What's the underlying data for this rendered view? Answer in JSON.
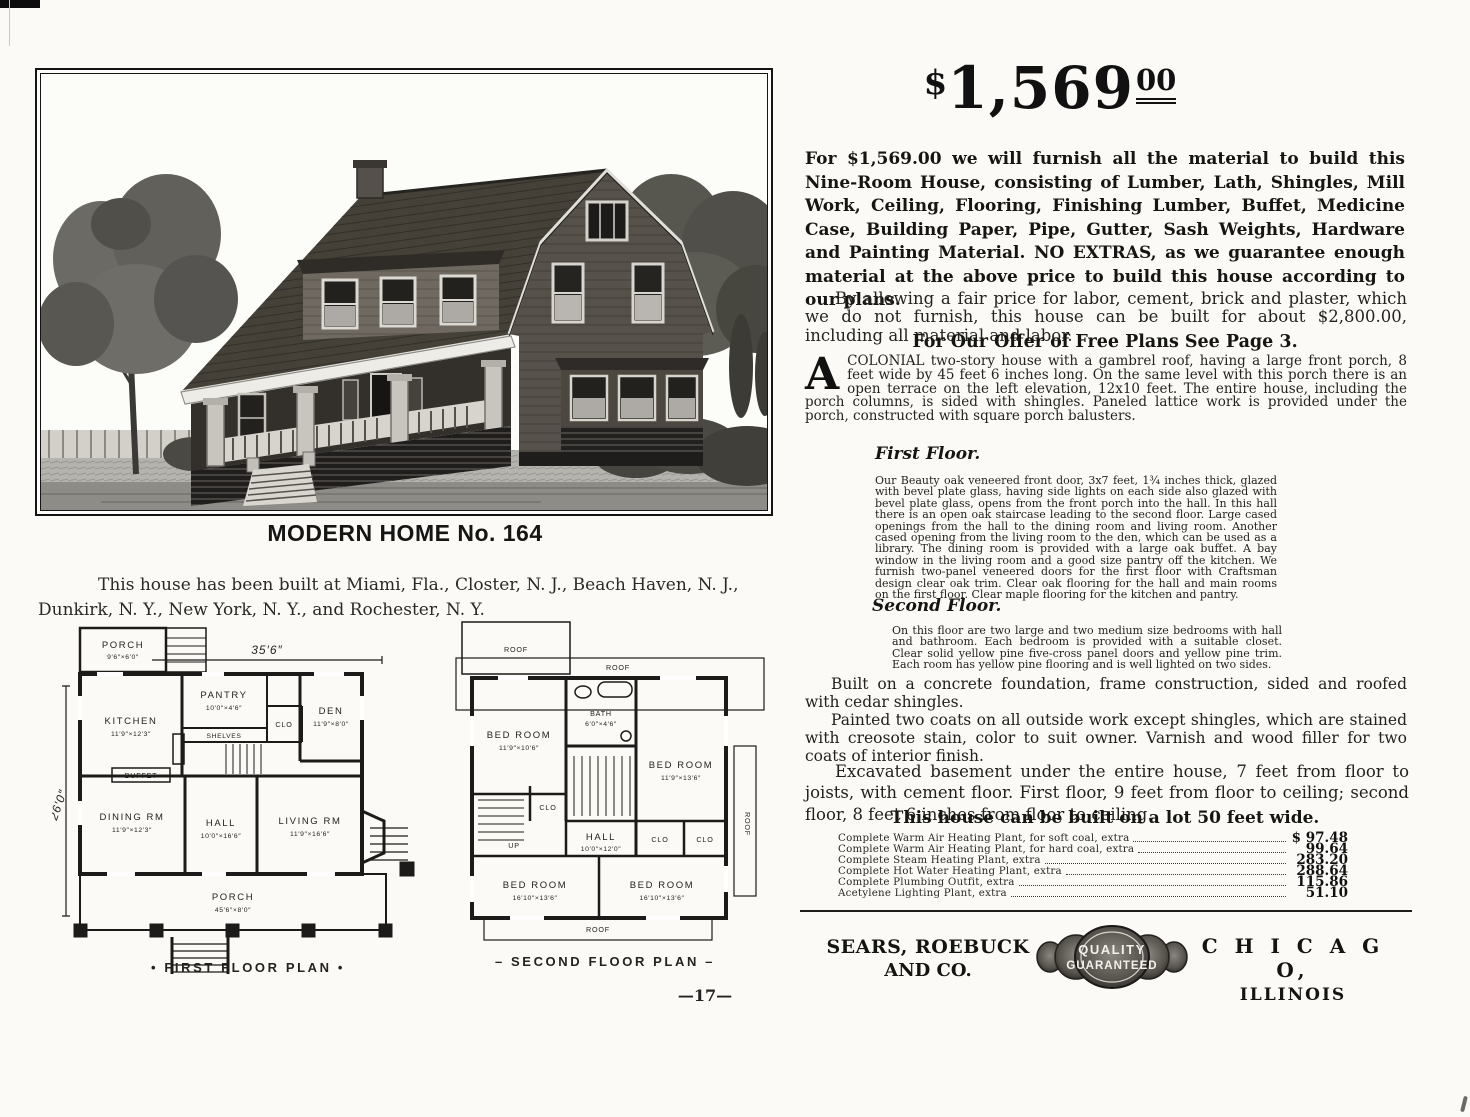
{
  "page": {
    "number": "—17—"
  },
  "left": {
    "title": "MODERN HOME No. 164",
    "built_at": "This house has been built at Miami, Fla., Closter, N. J., Beach Haven, N. J., Dunkirk, N. Y., New York, N. Y., and Rochester, N. Y."
  },
  "first_plan": {
    "caption": "• FIRST FLOOR PLAN •",
    "dim_width": "35′6″",
    "dim_height": "26′0″",
    "porch_top": {
      "name": "PORCH",
      "dim": "9′6″×6′0″"
    },
    "pantry": {
      "name": "PANTRY",
      "dim": "10′0″×4′6″"
    },
    "shelves": "SHELVES",
    "kitchen": {
      "name": "KITCHEN",
      "dim": "11′9″×12′3″"
    },
    "clo": "CLO",
    "den": {
      "name": "DEN",
      "dim": "11′9″×8′0″"
    },
    "buffet": "BUFFET",
    "dining": {
      "name": "DINING RM",
      "dim": "11′9″×12′3″"
    },
    "hall": {
      "name": "HALL",
      "dim": "10′0″×16′6″"
    },
    "living": {
      "name": "LIVING RM",
      "dim": "11′9″×16′6″"
    },
    "porch_bottom": {
      "name": "PORCH",
      "dim": "45′6″×8′0″"
    }
  },
  "second_plan": {
    "caption": "– SECOND FLOOR PLAN –",
    "roof_tl": "ROOF",
    "roof_top": "ROOF",
    "roof_right": "ROOF",
    "roof_bottom": "ROOF",
    "bed1": {
      "name": "BED ROOM",
      "dim": "11′9″×10′6″"
    },
    "bath": {
      "name": "BATH",
      "dim": "6′0″×4′6″"
    },
    "bed2": {
      "name": "BED ROOM",
      "dim": "11′9″×13′6″"
    },
    "hall": {
      "name": "HALL",
      "dim": "10′0″×12′0″"
    },
    "up": "UP",
    "clo1": "CLO",
    "clo2": "CLO",
    "clo3": "CLO",
    "bed3": {
      "name": "BED ROOM",
      "dim": "16′10″×13′6″"
    },
    "bed4": {
      "name": "BED ROOM",
      "dim": "16′10″×13′6″"
    }
  },
  "right": {
    "price": {
      "dollar": "$",
      "main": "1,569",
      "cents": "00"
    },
    "intro": "For $1,569.00 we will furnish all the material to build this Nine-Room House, consisting of Lumber, Lath, Shingles, Mill Work, Ceiling, Flooring, Finishing Lumber, Buffet, Medicine Case, Building Paper, Pipe, Gutter, Sash Weights, Hardware and Painting Material. NO EXTRAS, as we guarantee enough material at the above price to build this house according to our plans.",
    "labor": "By allowing a fair price for labor, cement, brick and plaster, which we do not furnish, this house can be built for about $2,800.00, including all material and labor.",
    "freeplans_heading": "For Our Offer of Free Plans See Page 3.",
    "colonial": {
      "dropcap": "A",
      "text": "COLONIAL two-story house with a gambrel roof, having a large front porch, 8 feet wide by 45 feet 6 inches long. On the same level with this porch there is an open terrace on the left elevation, 12x10 feet. The entire house, including the porch columns, is sided with shingles. Paneled lattice work is provided under the porch, constructed with square porch balusters."
    },
    "first_floor": {
      "heading": "First Floor.",
      "text": "Our Beauty oak veneered front door, 3x7 feet, 1¾ inches thick, glazed with bevel plate glass, having side lights on each side also glazed with bevel plate glass, opens from the front porch into the hall. In this hall there is an open oak staircase leading to the second floor. Large cased openings from the hall to the dining room and living room. Another cased opening from the living room to the den, which can be used as a library. The dining room is provided with a large oak buffet. A bay window in the living room and a good size pantry off the kitchen. We furnish two-panel veneered doors for the first floor with Craftsman design clear oak trim. Clear oak flooring for the hall and main rooms on the first floor. Clear maple flooring for the kitchen and pantry."
    },
    "second_floor": {
      "heading": "Second Floor.",
      "text": "On this floor are two large and two medium size bedrooms with hall and bathroom. Each bedroom is provided with a suitable closet. Clear solid yellow pine five-cross panel doors and yellow pine trim. Each room has yellow pine flooring and is well lighted on two sides."
    },
    "built_para": "Built on a concrete foundation, frame construction, sided and roofed with cedar shingles.",
    "painted_para": "Painted two coats on all outside work except shingles, which are stained with creosote stain, color to suit owner. Varnish and wood filler for two coats of interior finish.",
    "excavated_para": "Excavated basement under the entire house, 7 feet from floor to joists, with cement floor. First floor, 9 feet from floor to ceiling; second floor, 8 feet 6 inches from floor to ceiling.",
    "lot_heading": "This house can be built on a lot 50 feet wide.",
    "extras": [
      {
        "label": "Complete Warm Air Heating Plant, for soft coal, extra",
        "price": "$ 97.48"
      },
      {
        "label": "Complete Warm Air Heating Plant, for hard coal, extra",
        "price": "99.64"
      },
      {
        "label": "Complete Steam Heating Plant, extra",
        "price": "283.20"
      },
      {
        "label": "Complete Hot Water Heating Plant, extra",
        "price": "288.64"
      },
      {
        "label": "Complete Plumbing Outfit, extra",
        "price": "115.86"
      },
      {
        "label": "Acetylene Lighting Plant, extra",
        "price": "51.10"
      }
    ],
    "footer": {
      "company_l1": "SEARS, ROEBUCK",
      "company_l2": "AND CO.",
      "seal_l1": "QUALITY",
      "seal_l2": "GUARANTEED",
      "city_l1": "C H I C A G O,",
      "city_l2": "ILLINOIS"
    }
  }
}
